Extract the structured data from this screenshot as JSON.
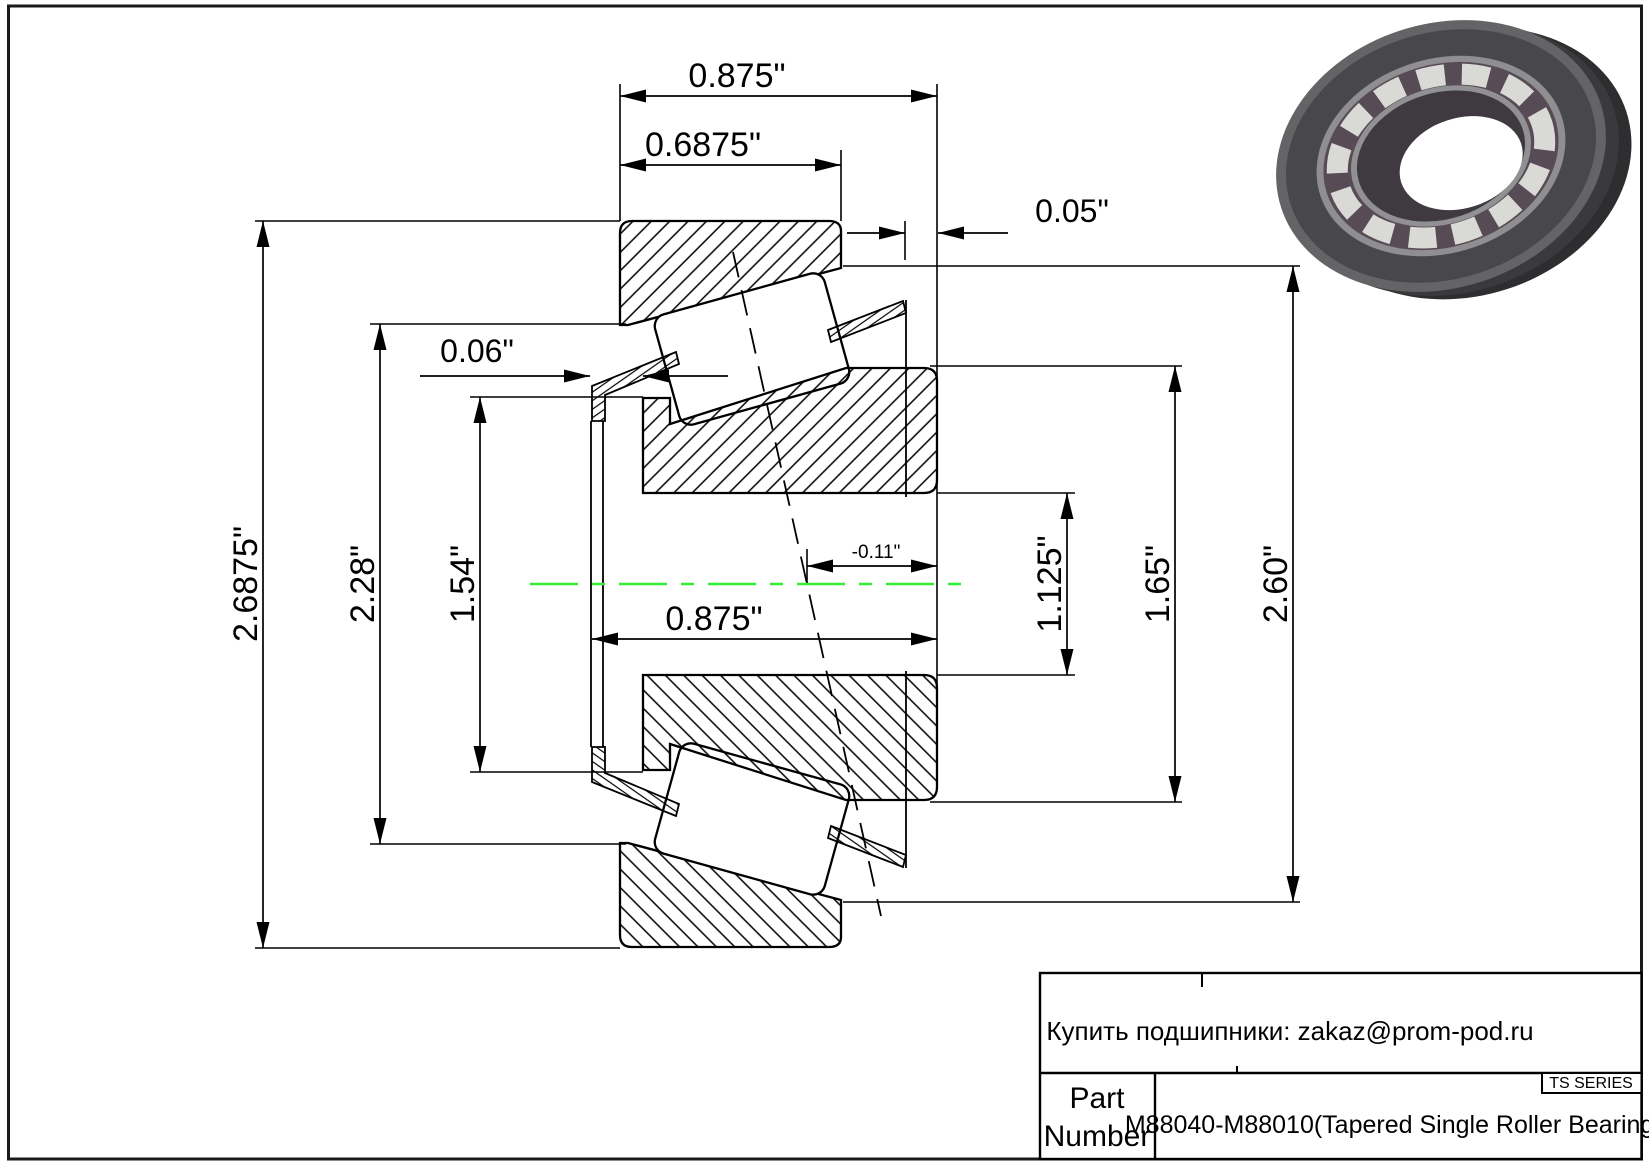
{
  "page": {
    "background": "#ffffff",
    "line_color": "#000000",
    "centerline_color": "#33ee33"
  },
  "drawing": {
    "type": "tapered-roller-bearing-cross-section",
    "dimensions": {
      "overall_width_top": "0.875\"",
      "cup_width": "0.6875\"",
      "back_standout": "0.05\"",
      "front_standout": "0.06\"",
      "effective_center_offset": "-0.11\"",
      "cone_width": "0.875\"",
      "outer_diameter": "2.6875\"",
      "race_diameter": "2.28\"",
      "front_diameter": "1.54\"",
      "bore_diameter": "1.125\"",
      "rib_diameter": "1.65\"",
      "cup_outer_diameter": "2.60\""
    }
  },
  "title_block": {
    "note": "Купить подшипники: zakaz@prom-pod.ru",
    "part_label_line1": "Part",
    "part_label_line2": "Number",
    "part_number": "M88040-M88010(Tapered Single Roller Bearings)",
    "series_label": "TS SERIES"
  },
  "bearing_render": {
    "body_color": "#4a4a4c",
    "face_color": "#646467",
    "rim_color": "#8f8f92",
    "cage_color": "#574c55",
    "roller_color": "#d9d9d6",
    "bore_color": "#3e3a3f"
  }
}
